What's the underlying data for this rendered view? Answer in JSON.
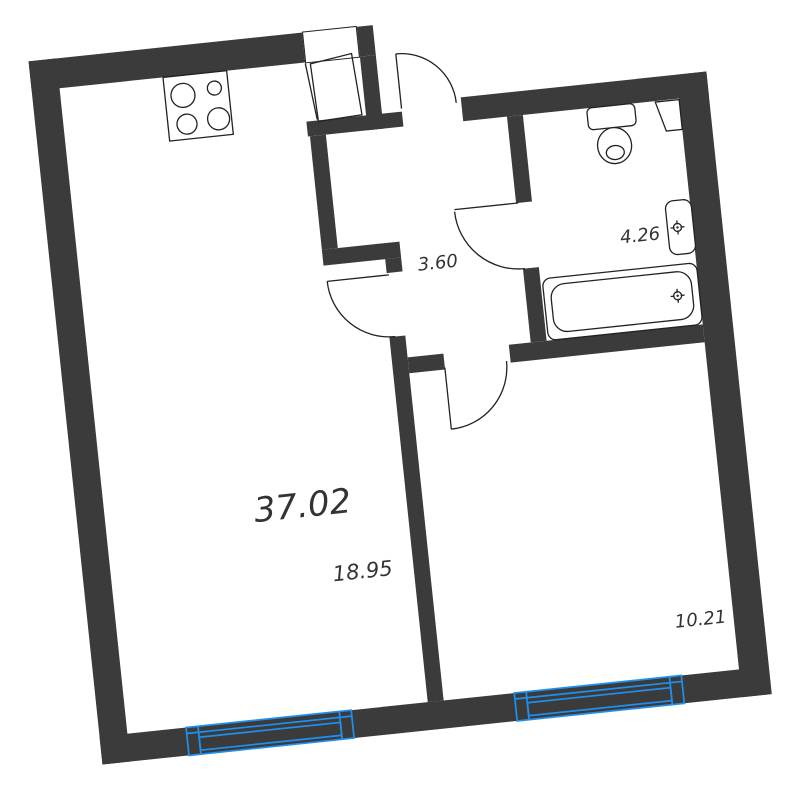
{
  "floorplan": {
    "type": "apartment-floor-plan",
    "labels": {
      "total_area": "37.02",
      "living_room_area": "18.95",
      "hallway_area": "3.60",
      "bathroom_area": "4.26",
      "bedroom_area": "10.21"
    },
    "fixtures": [
      "stove-icon",
      "toilet-icon",
      "corner-shelf-icon",
      "sink-icon",
      "bathtub-icon",
      "faucet-mark-icon",
      "window-icon",
      "door-swing-icon",
      "entrance-door-leaf-icon"
    ]
  },
  "colors": {
    "wall": "#3b3b3b",
    "line": "#222222",
    "window": "#2090ef",
    "label": "#333333",
    "bg": "#ffffff"
  }
}
